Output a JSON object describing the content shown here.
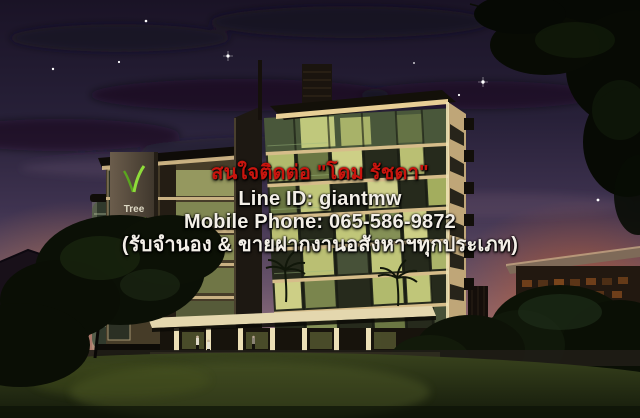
{
  "overlay": {
    "contact": "สนใจติดต่อ \"โดม รัชดา\"",
    "line_id": "Line ID: giantmw",
    "mobile": "Mobile Phone: 065-586-9872",
    "services": "(รับจำนอง & ขายฝากงานอสังหาฯทุกประเภท)"
  },
  "building_sign": {
    "brand": "Tree"
  },
  "colors": {
    "contact_text": "#c9150e",
    "info_text": "#f3efe7",
    "sky_top": "#1a1326",
    "sky_mid": "#4a3a55",
    "horizon_pink": "#a87f72",
    "sunset_orange": "#c06a32",
    "window_glow": "#d6d88c",
    "facade_light": "#e6cf96",
    "logo_green": "#7ec62e",
    "grass_dark": "#2a3315",
    "foliage_dark": "#0a0e05"
  }
}
